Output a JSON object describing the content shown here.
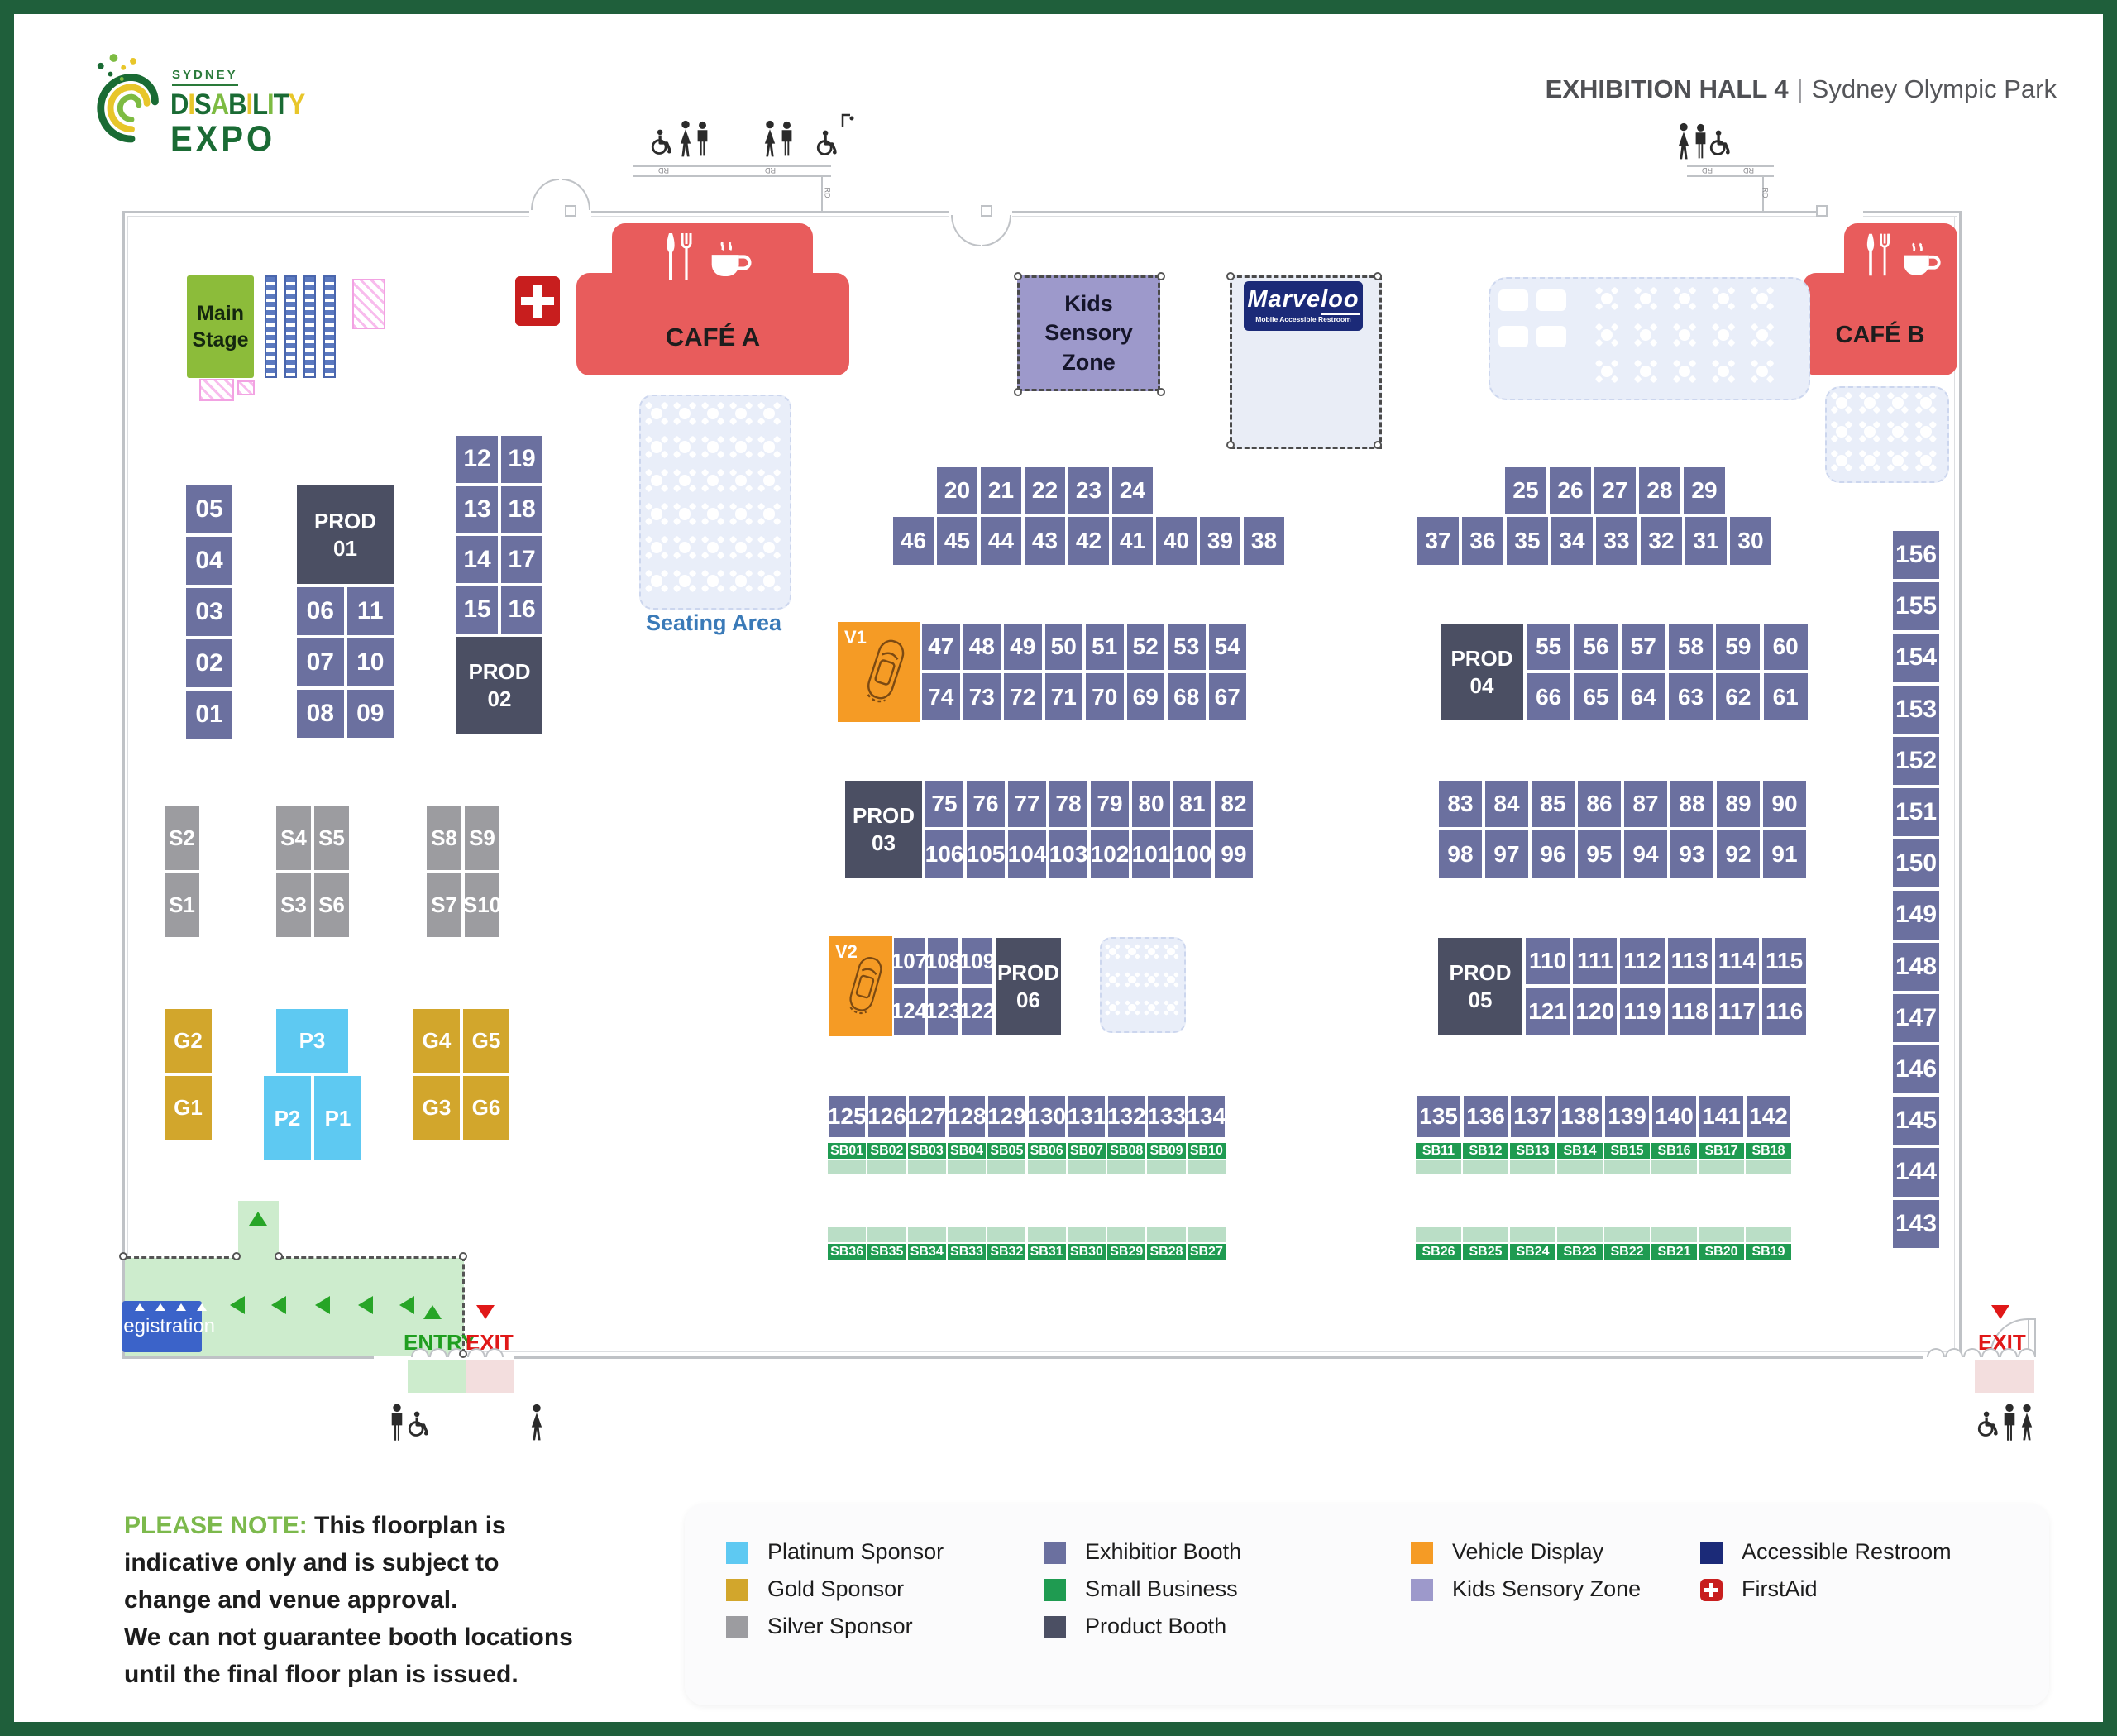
{
  "header": {
    "hall": "EXHIBITION HALL 4",
    "sep": "|",
    "venue": "Sydney Olympic Park"
  },
  "logo": {
    "city": "SYDNEY",
    "word1": "DISABILITY",
    "word2": "EXPO",
    "word1_colors": [
      "#1a6b34",
      "#e8c62a",
      "#1a6b34",
      "#7dbb42",
      "#1a6b34",
      "#e8c62a",
      "#1a6b34",
      "#7dbb42",
      "#1a6b34",
      "#e8c62a"
    ]
  },
  "areas": {
    "main_stage": "Main\nStage",
    "cafe_a": "CAFÉ A",
    "cafe_b": "CAFÉ B",
    "seating_area": "Seating Area",
    "kids_zone": "Kids Sensory\nZone",
    "marveloo": {
      "name": "Marveloo",
      "subtitle": "Mobile Accessible Restroom"
    },
    "registration": "Registration",
    "entry": "ENTRY",
    "exit": "EXIT",
    "v1": "V1",
    "v2": "V2",
    "rd": "RD"
  },
  "prods": {
    "01": "PROD\n01",
    "02": "PROD\n02",
    "03": "PROD\n03",
    "04": "PROD\n04",
    "05": "PROD\n05",
    "06": "PROD\n06"
  },
  "booths": {
    "left_col": [
      "05",
      "04",
      "03",
      "02",
      "01"
    ],
    "prod1_grid": [
      [
        "06",
        "11"
      ],
      [
        "07",
        "10"
      ],
      [
        "08",
        "09"
      ]
    ],
    "block12": [
      [
        "12",
        "19"
      ],
      [
        "13",
        "18"
      ],
      [
        "14",
        "17"
      ],
      [
        "15",
        "16"
      ]
    ],
    "a_left_top": [
      "20",
      "21",
      "22",
      "23",
      "24"
    ],
    "a_left_bottom": [
      "46",
      "45",
      "44",
      "43",
      "42",
      "41",
      "40",
      "39",
      "38"
    ],
    "a_right_top": [
      "25",
      "26",
      "27",
      "28",
      "29"
    ],
    "a_right_bottom": [
      "37",
      "36",
      "35",
      "34",
      "33",
      "32",
      "31",
      "30"
    ],
    "b_left_top": [
      "47",
      "48",
      "49",
      "50",
      "51",
      "52",
      "53",
      "54"
    ],
    "b_left_bottom": [
      "74",
      "73",
      "72",
      "71",
      "70",
      "69",
      "68",
      "67"
    ],
    "b_right_top": [
      "55",
      "56",
      "57",
      "58",
      "59",
      "60"
    ],
    "b_right_bottom": [
      "66",
      "65",
      "64",
      "63",
      "62",
      "61"
    ],
    "c_left_top": [
      "75",
      "76",
      "77",
      "78",
      "79",
      "80",
      "81",
      "82"
    ],
    "c_left_bottom": [
      "106",
      "105",
      "104",
      "103",
      "102",
      "101",
      "100",
      "99"
    ],
    "c_right_top": [
      "83",
      "84",
      "85",
      "86",
      "87",
      "88",
      "89",
      "90"
    ],
    "c_right_bottom": [
      "98",
      "97",
      "96",
      "95",
      "94",
      "93",
      "92",
      "91"
    ],
    "d_left_top": [
      "107",
      "108",
      "109"
    ],
    "d_left_bottom": [
      "124",
      "123",
      "122"
    ],
    "d_right_top": [
      "110",
      "111",
      "112",
      "113",
      "114",
      "115"
    ],
    "d_right_bottom": [
      "121",
      "120",
      "119",
      "118",
      "117",
      "116"
    ],
    "e_left": [
      "125",
      "126",
      "127",
      "128",
      "129",
      "130",
      "131",
      "132",
      "133",
      "134"
    ],
    "e_right": [
      "135",
      "136",
      "137",
      "138",
      "139",
      "140",
      "141",
      "142"
    ],
    "sb_left_top": [
      "SB01",
      "SB02",
      "SB03",
      "SB04",
      "SB05",
      "SB06",
      "SB07",
      "SB08",
      "SB09",
      "SB10"
    ],
    "sb_left_bottom": [
      "SB36",
      "SB35",
      "SB34",
      "SB33",
      "SB32",
      "SB31",
      "SB30",
      "SB29",
      "SB28",
      "SB27"
    ],
    "sb_right_top": [
      "SB11",
      "SB12",
      "SB13",
      "SB14",
      "SB15",
      "SB16",
      "SB17",
      "SB18"
    ],
    "sb_right_bottom": [
      "SB26",
      "SB25",
      "SB24",
      "SB23",
      "SB22",
      "SB21",
      "SB20",
      "SB19"
    ],
    "right_col": [
      "156",
      "155",
      "154",
      "153",
      "152",
      "151",
      "150",
      "149",
      "148",
      "147",
      "146",
      "145",
      "144",
      "143"
    ]
  },
  "sponsors": {
    "silver_col": [
      "S2",
      "S1"
    ],
    "silver_quad1": [
      [
        "S4",
        "S5"
      ],
      [
        "S3",
        "S6"
      ]
    ],
    "silver_quad2": [
      [
        "S8",
        "S9"
      ],
      [
        "S7",
        "S10"
      ]
    ],
    "gold_col": [
      "G2",
      "G1"
    ],
    "gold_quad": [
      [
        "G4",
        "G5"
      ],
      [
        "G3",
        "G6"
      ]
    ],
    "platinum_top": "P3",
    "platinum_bottom": [
      "P2",
      "P1"
    ]
  },
  "legend": [
    {
      "label": "Platinum Sponsor",
      "color": "#5ec9f2"
    },
    {
      "label": "Gold Sponsor",
      "color": "#d2a62c"
    },
    {
      "label": "Silver Sponsor",
      "color": "#9c9ca0"
    },
    {
      "label": "Exhibitior Booth",
      "color": "#6b709f"
    },
    {
      "label": "Small Business",
      "color": "#1f9b51"
    },
    {
      "label": "Product Booth",
      "color": "#4b4f63"
    },
    {
      "label": "Vehicle Display",
      "color": "#f59b25"
    },
    {
      "label": "Kids Sensory Zone",
      "color": "#9d99cb"
    },
    {
      "label": "Accessible Restroom",
      "color": "#1b2a78"
    },
    {
      "label": "FirstAid",
      "color": "#c81e1e",
      "cross": true
    }
  ],
  "note": {
    "lead": "PLEASE NOTE:",
    "lines": [
      "This floorplan is",
      "indicative only and is subject to",
      "change and venue approval.",
      "We can not guarantee booth locations",
      "until the final floor plan is issued."
    ]
  },
  "colors": {
    "frame_green": "#1f5f3b",
    "exhibitor": "#6b709f",
    "product": "#4b4f63",
    "small_business": "#1f9b51",
    "vehicle": "#f59b25",
    "kids": "#9d99cb",
    "platinum": "#5ec9f2",
    "gold": "#d2a62c",
    "silver": "#9c9ca0",
    "cafe": "#e85c5c",
    "stage": "#8cbc3a",
    "registration_blue": "#3b63c9",
    "corridor_green": "#cdeccd",
    "navy": "#1b2a78",
    "firstaid_red": "#c81e1e"
  }
}
